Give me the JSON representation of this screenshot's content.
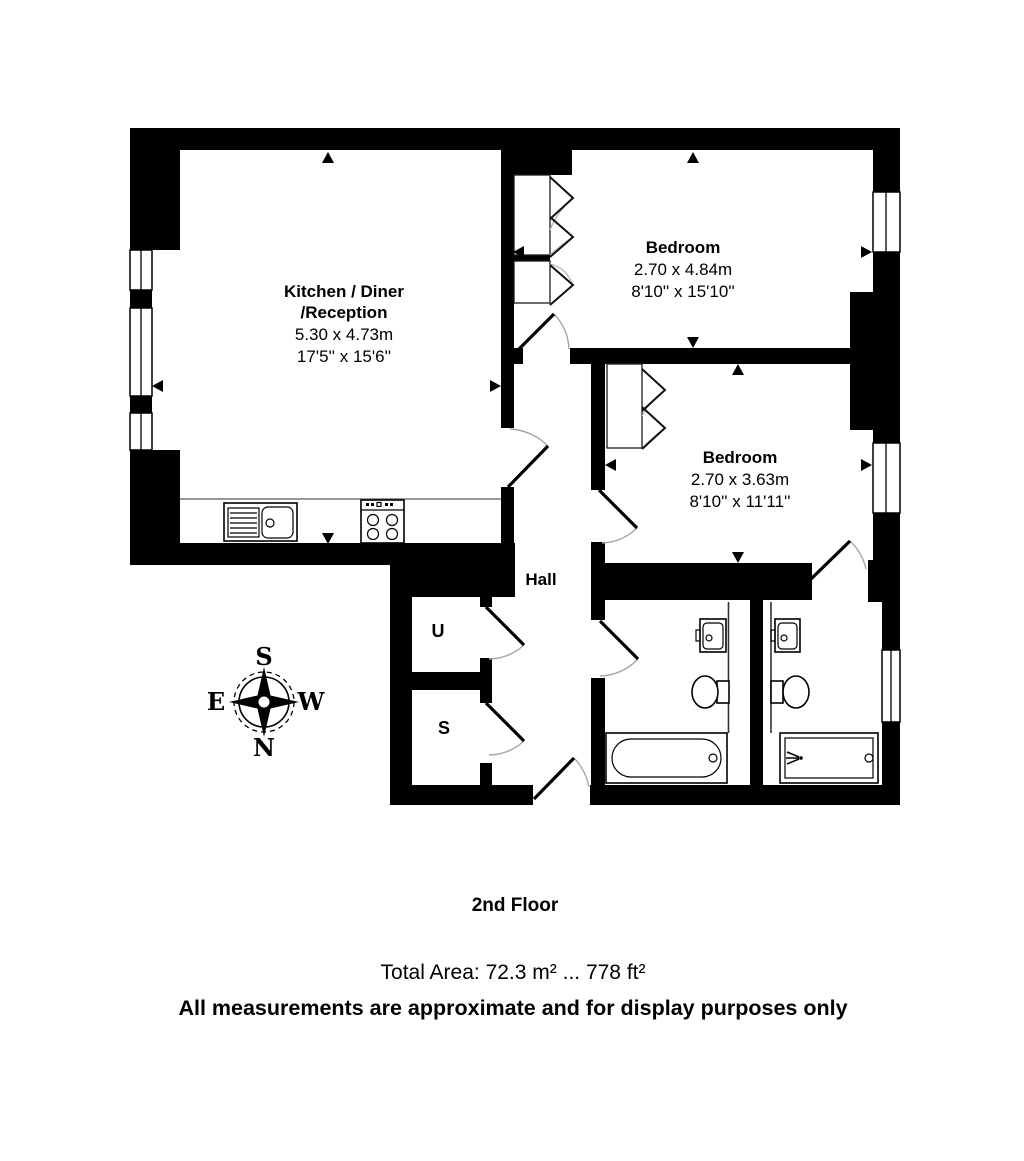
{
  "floor_label": "2nd Floor",
  "footer": {
    "total_area": "Total Area: 72.3 m² ... 778 ft²",
    "disclaimer": "All measurements are approximate and for display purposes only"
  },
  "rooms": {
    "kitchen": {
      "name_line1": "Kitchen / Diner",
      "name_line2": "/Reception",
      "dims_metric": "5.30 x 4.73m",
      "dims_imperial": "17'5'' x 15'6''"
    },
    "bedroom1": {
      "name": "Bedroom",
      "dims_metric": "2.70 x 4.84m",
      "dims_imperial": "8'10'' x 15'10''"
    },
    "bedroom2": {
      "name": "Bedroom",
      "dims_metric": "2.70 x 3.63m",
      "dims_imperial": "8'10'' x 11'11''"
    },
    "hall": {
      "name": "Hall"
    },
    "cupboard_u": {
      "name": "U"
    },
    "cupboard_s": {
      "name": "S"
    }
  },
  "compass": {
    "north": "N",
    "south": "S",
    "east": "E",
    "west": "W"
  },
  "colors": {
    "walls": "#000000",
    "background": "#ffffff",
    "door_arc": "#a6a6a6"
  }
}
